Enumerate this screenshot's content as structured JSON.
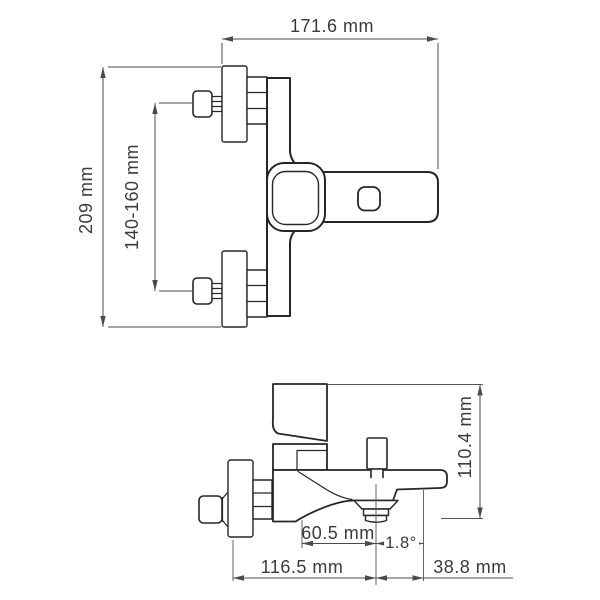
{
  "drawing": {
    "type": "technical-dimension-drawing",
    "subject": "wall-mounted bath mixer faucet, two orthographic views",
    "units": "mm",
    "colors": {
      "background": "#ffffff",
      "object_lines": "#262626",
      "dimension_lines": "#4a4a4a",
      "dimension_text": "#3a3a3a"
    },
    "front_view": {
      "width_label": "171.6 mm",
      "height_label": "209 mm",
      "mount_span_label": "140-160 mm"
    },
    "side_view": {
      "height_label": "110.4 mm",
      "outlet_offset_label": "60.5 mm",
      "angle_label": "1.8°",
      "reach_label": "116.5 mm",
      "rear_offset_label": "38.8 mm"
    }
  }
}
